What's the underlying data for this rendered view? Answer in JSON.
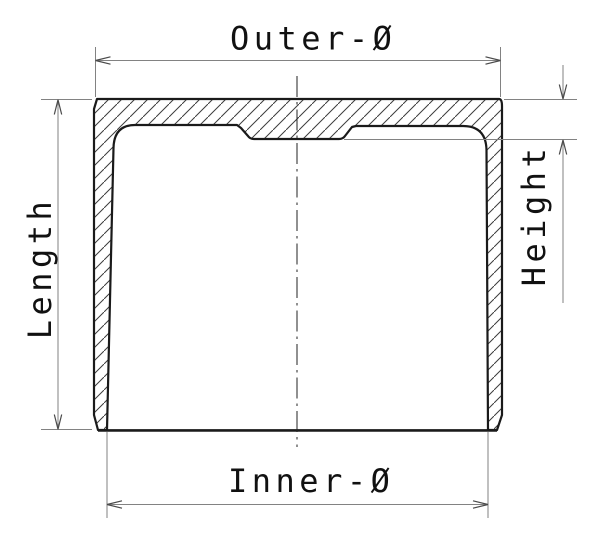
{
  "drawing": {
    "title": "valve-tappet-cross-section",
    "dimensions": {
      "outer_diameter_label": "Outer-Ø",
      "inner_diameter_label": "Inner-Ø",
      "length_label": "Length",
      "height_label": "Height"
    },
    "colors": {
      "outline": "#1a1a1a",
      "dimension_line": "#828282",
      "arrow": "#4a4a4a",
      "hatch": "#3c3c3c",
      "text": "#111111",
      "background": "#ffffff"
    }
  }
}
